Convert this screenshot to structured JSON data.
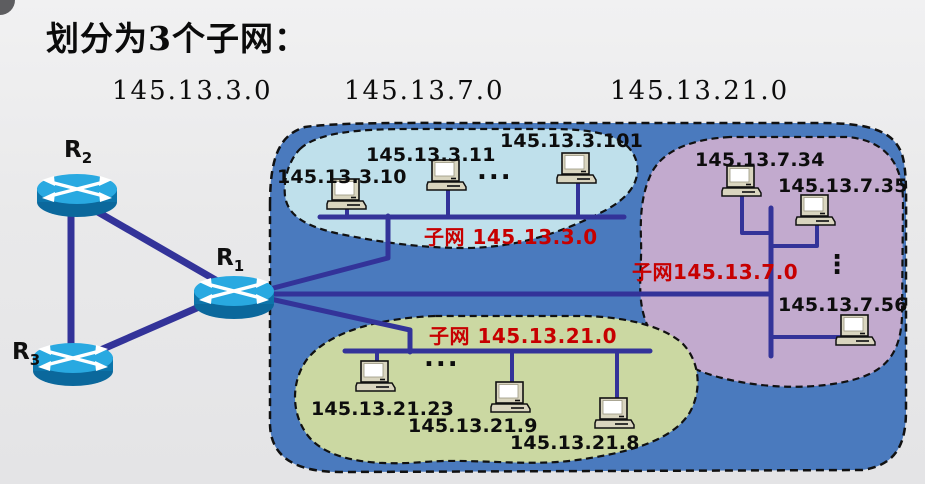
{
  "title": "划分为3个子网：",
  "subnet_headings": [
    "145.13.3.0",
    "145.13.7.0",
    "145.13.21.0"
  ],
  "routers": [
    {
      "base": "R",
      "sub": "2"
    },
    {
      "base": "R",
      "sub": "1"
    },
    {
      "base": "R",
      "sub": "3"
    }
  ],
  "subnets": [
    {
      "label": "子网 145.13.3.0",
      "hosts": [
        "145.13.3.10",
        "145.13.3.11",
        "145.13.3.101"
      ],
      "ellipsis": "...",
      "fill": "#bfe0eb"
    },
    {
      "label": "子网145.13.7.0",
      "hosts": [
        "145.13.7.34",
        "145.13.7.35",
        "145.13.7.56"
      ],
      "ellipsis": "⋮",
      "fill": "#c2aace"
    },
    {
      "label": "子网 145.13.21.0",
      "hosts": [
        "145.13.21.23",
        "145.13.21.9",
        "145.13.21.8"
      ],
      "ellipsis": "...",
      "fill": "#cbd8a2"
    }
  ],
  "colors": {
    "network_cloud": "#4a7abe",
    "link": "#333399",
    "subnet_label_red": "#c70000",
    "router_top": "#29a9e1",
    "router_side": "#0c74aa",
    "pc_case": "#d9d5bf"
  }
}
